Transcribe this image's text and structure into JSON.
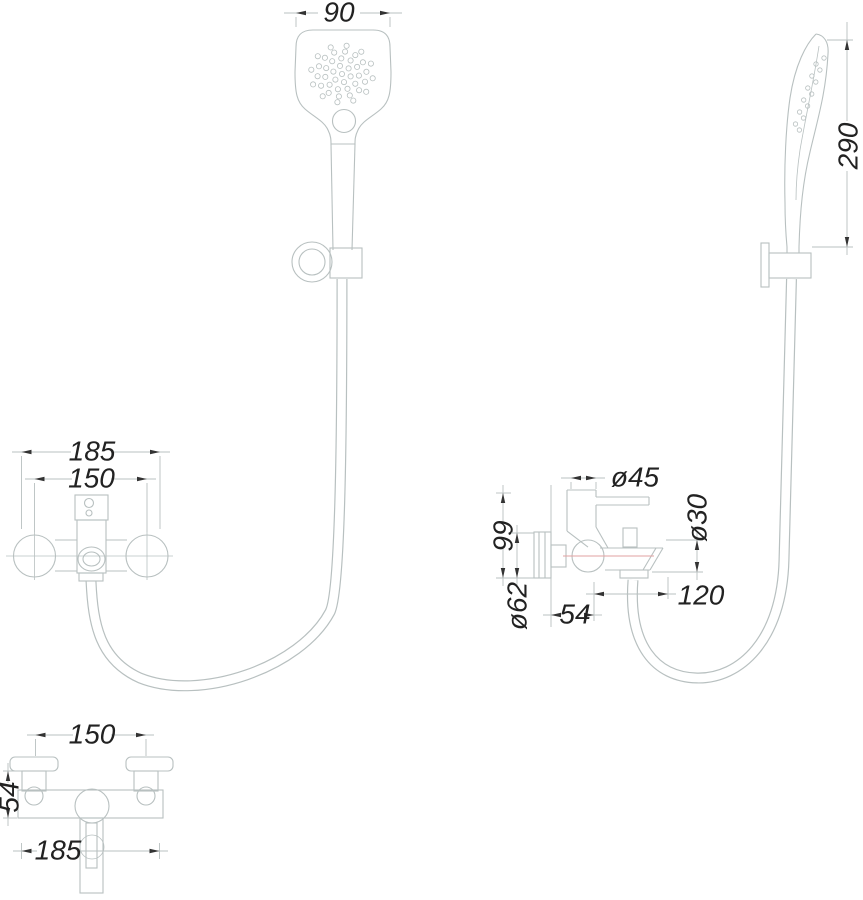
{
  "drawing": {
    "kind": "shower-mixer-set-installation-drawing",
    "dims": {
      "head_width": "90",
      "head_height": "290",
      "mixer_width_overall": "185",
      "mixer_width_centers": "150",
      "handle_dia": "ø45",
      "body_height": "99",
      "escutcheon_dia": "ø62",
      "wall_to_center": "54",
      "spout_reach": "120",
      "outlet_dia": "ø30",
      "plan_centers": "150",
      "plan_depth": "54",
      "plan_width_overall": "185"
    },
    "colors": {
      "line": "#b8c0c0",
      "centerline": "#e2a2a2",
      "text": "#222222",
      "arrow": "#333333"
    }
  }
}
